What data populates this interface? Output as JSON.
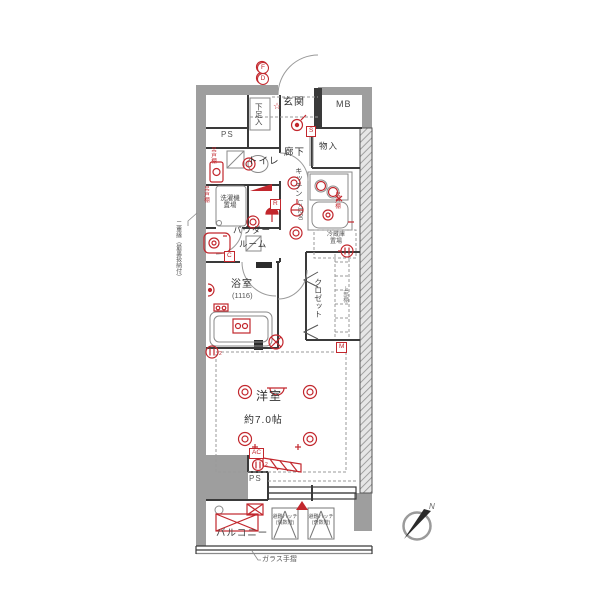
{
  "colors": {
    "accent_red": "#c2272d",
    "wall_gray": "#9e9e9e",
    "line_dark": "#3a3a3a",
    "fixture_gray": "#8a8a8a"
  },
  "rooms": {
    "genkan": "玄関",
    "shoe_box": "下足入",
    "mb": "MB",
    "ps_top": "PS",
    "toilet": "トイレ",
    "hallway": "廊下",
    "storage": "物入",
    "kitchen": "キッチン",
    "kitchen_length": "L=1200",
    "laundry_l1": "洗濯機",
    "laundry_l2": "置場",
    "powder_l1": "パウダー",
    "powder_l2": "ルーム",
    "bath": "浴室",
    "bath_size": "(1116)",
    "fridge_l1": "冷蔵庫",
    "fridge_l2": "置場",
    "closet": "クロゼット",
    "closet_shelf": "上部棚",
    "main": "洋室",
    "main_size": "約7.0帖",
    "ps_bottom": "PS",
    "balcony": "バルコニー"
  },
  "equipment_badges": {
    "fd_f": "F",
    "fd_d": "D",
    "switch": "S",
    "r": "R",
    "c": "C",
    "m": "M",
    "ac": "AC",
    "outlet_sub_main": "2",
    "outlet_sub_ac": "2"
  },
  "annotations": {
    "cupboard": "吊戸棚",
    "hatch_even_l1": "避難ハッチ",
    "hatch_even_l2": "(偶数階)",
    "hatch_odd_l1": "避難ハッチ",
    "hatch_odd_l2": "(奇数階)",
    "glass_rail": "ガラス手摺",
    "left_note": "二重縁（最裏扱納付）",
    "star": "☆",
    "north": "N"
  },
  "icons": {
    "fire-damper-icon": "two stacked red circles F/D",
    "star-icon": "☆ red marker in entrance",
    "downlight-icon": "red double circle",
    "outlet-icon": "red circle with twin bars",
    "switch-badge-icon": "red boxed letter",
    "emergency-hatch-icon": "square with apex lines",
    "compass-icon": "circle with north arrow"
  }
}
